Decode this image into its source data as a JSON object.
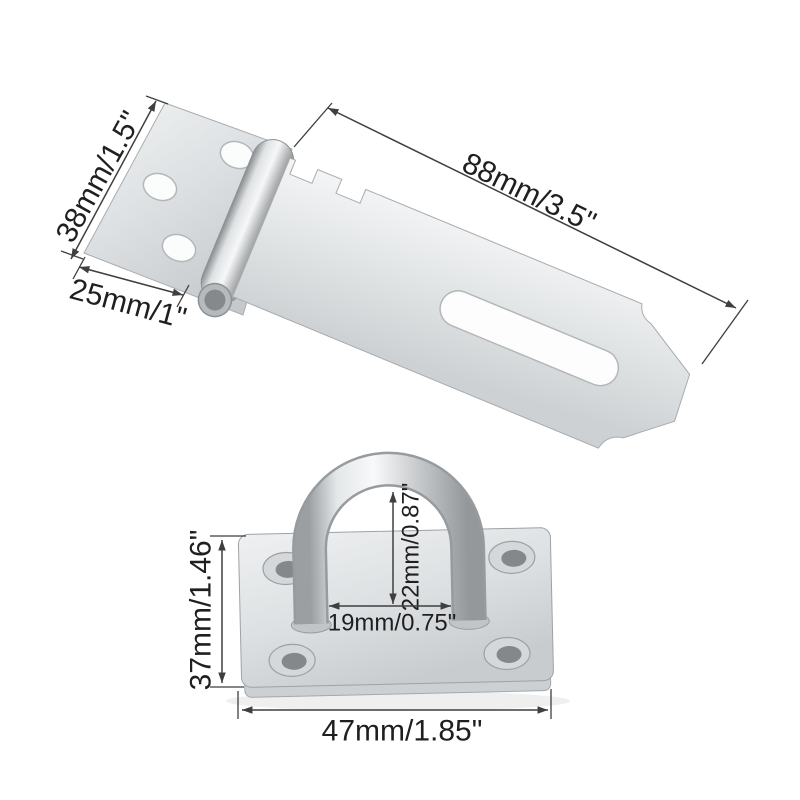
{
  "background": "#ffffff",
  "colors": {
    "dimension_line": "#3f3f3f",
    "label_text": "#1f1f1f",
    "metal_light": "#f6f7f8",
    "metal_mid": "#d9dcde",
    "metal_dark": "#9fa3a6"
  },
  "hasp": {
    "dims": {
      "leaf_width": {
        "label": "38mm/1.5\"",
        "mm": 38,
        "inch": 1.5
      },
      "leaf_depth": {
        "label": "25mm/1\"",
        "mm": 25,
        "inch": 1
      },
      "plate_length": {
        "label": "88mm/3.5\"",
        "mm": 88,
        "inch": 3.5
      }
    }
  },
  "staple": {
    "dims": {
      "plate_height": {
        "label": "37mm/1.46\"",
        "mm": 37,
        "inch": 1.46
      },
      "plate_width": {
        "label": "47mm/1.85\"",
        "mm": 47,
        "inch": 1.85
      },
      "loop_inner_height": {
        "label": "22mm/0.87\"",
        "mm": 22,
        "inch": 0.87
      },
      "loop_inner_width": {
        "label": "19mm/0.75\"",
        "mm": 19,
        "inch": 0.75
      }
    }
  }
}
